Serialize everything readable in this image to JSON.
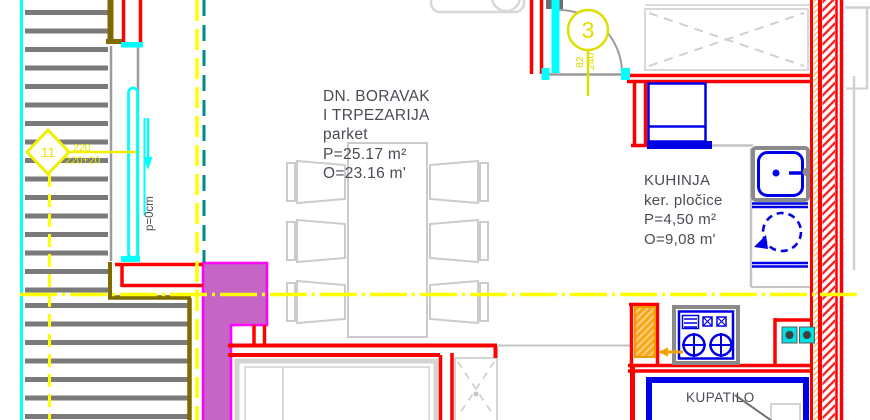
{
  "rooms": {
    "living": {
      "lines": [
        "DN. BORAVAK",
        "I TRPEZARIJA",
        "parket",
        "P=25.17 m²",
        "O=23.16 m'"
      ]
    },
    "kitchen": {
      "lines": [
        "KUHINJA",
        "ker. pločice",
        "P=4,50 m²",
        "O=9,08 m'"
      ]
    },
    "bathroom": {
      "label": "KUPATILO"
    }
  },
  "annotations": {
    "door_circle_number": "3",
    "door_dim_width": "82",
    "door_dim_height": "240",
    "stair_diamond_number": "11",
    "stair_dim_line1": "220",
    "stair_dim_line2": "220+20",
    "slope_label": "p=0cm"
  },
  "colors": {
    "wall_red": "#ff0000",
    "fixture_blue": "#0000e8",
    "door_cyan": "#00ffff",
    "section_yellow": "#ffff00",
    "marker_yellow": "#dede00",
    "teal_dash": "#008b8b",
    "chimney_fill": "#c565c5",
    "chimney_outline": "#ff00ff",
    "terrace_olive": "#7f6a00",
    "boiler_orange": "#f5a623",
    "furniture_gray": "#cccccc",
    "text_gray": "#4b4b55"
  }
}
